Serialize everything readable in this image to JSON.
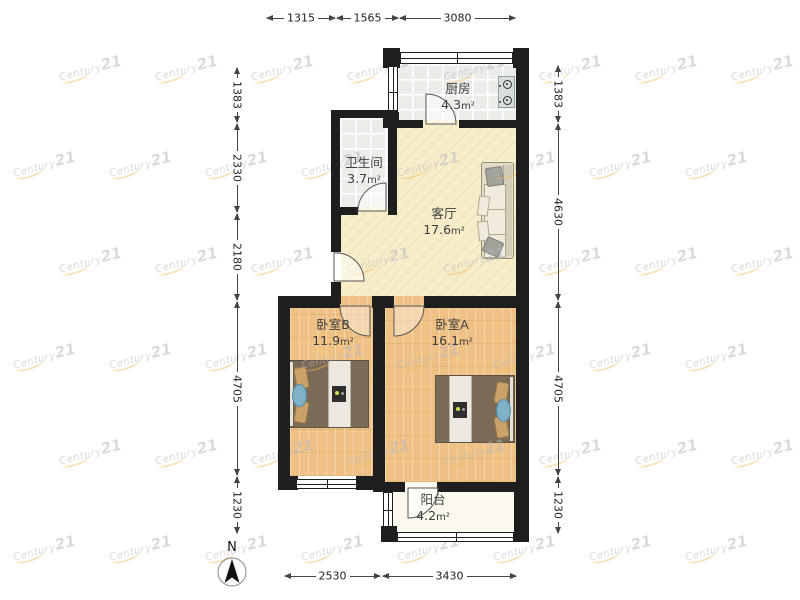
{
  "rooms": {
    "kitchen": {
      "name": "厨房",
      "area": "4.3",
      "unit": "m²"
    },
    "bathroom": {
      "name": "卫生间",
      "area": "3.7",
      "unit": "m²"
    },
    "living": {
      "name": "客厅",
      "area": "17.6",
      "unit": "m²"
    },
    "bedroom_b": {
      "name": "卧室B",
      "area": "11.9",
      "unit": "m²"
    },
    "bedroom_a": {
      "name": "卧室A",
      "area": "16.1",
      "unit": "m²"
    },
    "balcony": {
      "name": "阳台",
      "area": "4.2",
      "unit": "m²"
    }
  },
  "dimensions_mm": {
    "top": [
      "1315",
      "1565",
      "3080"
    ],
    "left": [
      "1383",
      "2330",
      "2180",
      "4705",
      "1230"
    ],
    "right": [
      "1383",
      "4630",
      "4705",
      "1230"
    ],
    "bottom": [
      "2530",
      "3430"
    ]
  },
  "compass": {
    "label": "N"
  },
  "watermark": {
    "brand": "Century",
    "suffix": "21"
  },
  "colors": {
    "wall": "#1e1e1e",
    "wood_floor": "#efc185",
    "living_floor": "#f7eecb",
    "tile_floor": "#ecece8",
    "balcony_floor": "#fbf9ee",
    "watermark_swoosh": "#f0b95e"
  }
}
